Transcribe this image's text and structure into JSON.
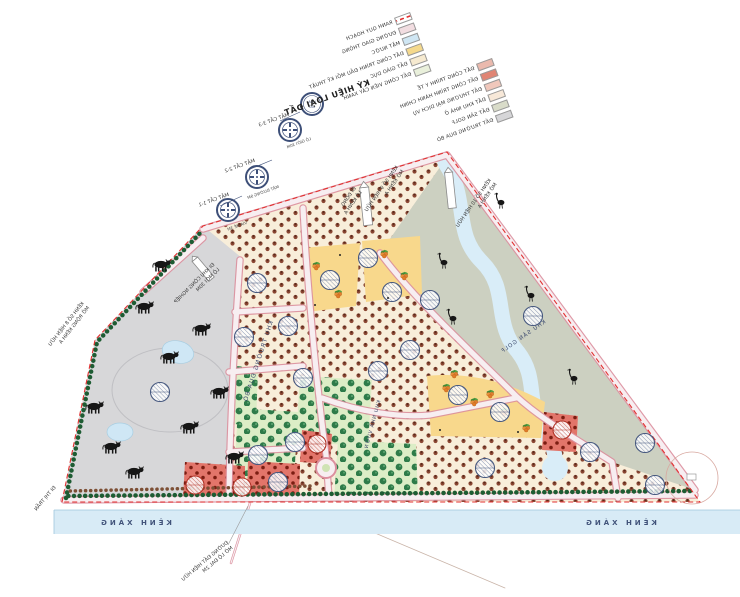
{
  "legend": {
    "title": "KÝ HIỆU LOẠI ĐẤT",
    "column_a": [
      {
        "label": "RANH QUY HOẠCH",
        "color": "#ffffff",
        "variant": "ranh"
      },
      {
        "label": "ĐƯỜNG GIAO THÔNG",
        "color": "#f2dde1"
      },
      {
        "label": "MẶT NƯỚC",
        "color": "#cfe6f3"
      },
      {
        "label": "ĐẤT CÔNG TRÌNH ĐẦU MỐI KỸ THUẬT",
        "color": "#f5d98c"
      },
      {
        "label": "ĐẤT GIÁO DỤC",
        "color": "#f6ead0"
      },
      {
        "label": "ĐẤT CÔNG VIÊN CÂY XANH",
        "color": "#e9f0db"
      }
    ],
    "column_b": [
      {
        "label": "ĐẤT CÔNG TRÌNH Y TẾ",
        "color": "#eab9ad"
      },
      {
        "label": "ĐẤT CÔNG TRÌNH HÀNH CHÍNH",
        "color": "#e08473"
      },
      {
        "label": "ĐẤT THƯƠNG MẠI DỊCH VỤ",
        "color": "#f0c7bb"
      },
      {
        "label": "ĐẤT KHU NHÀ Ở",
        "color": "#f7e8d8"
      },
      {
        "label": "ĐẤT SÂN GOLF",
        "color": "#d9dcc9"
      },
      {
        "label": "ĐẤT TRƯỜNG ĐUA BÒ",
        "color": "#d6d6d8"
      }
    ]
  },
  "map": {
    "zones": {
      "pasture": "KHU TRƯỜNG ĐUA BÒ",
      "golf": "KHU SÂN GOLF",
      "orchard": "KHU NHÀ VƯỜN"
    },
    "canal_label": "KÊNH XÁNG",
    "wind_rose": [
      "HOA",
      "GIÓ"
    ],
    "sections": [
      "MẶT CẮT 3-3",
      "MẶT CẮT 2-2",
      "MẶT CẮT 1-1"
    ],
    "dimensions": [
      "LỘ GIỚI 30M",
      "MẶT ĐƯỜNG 9M",
      "VỈA HÈ 3M"
    ],
    "edge_labels": [
      {
        "l1": "KÊNH SỐ 8 HIỆN HỮU",
        "l2": "MỞ RỘNG KÊNH A"
      },
      {
        "l1": "ĐI KHU CÔNG NGHIỆP",
        "l2": "LỘ MỚI 30M"
      },
      {
        "l1": "ĐI ĐỒNG",
        "l2": "LỘ KÊNH A"
      },
      {
        "l1": "KÊNH SỐ 9 HIỆN HỮU",
        "l2": "MỞ KÊNH A"
      },
      {
        "l1": "KÊNH SỐ 10 HIỆN HỮU",
        "l2": "MỞ KÊNH A"
      },
      {
        "l1": "ĐƯỜNG ĐẤT HIỆN HỮU",
        "l2": "MỞ LỘ ĐAL 2M"
      },
      {
        "l1": "ĐI THỊ TRẤN",
        "l2": ""
      }
    ]
  },
  "colors": {
    "pasture": "#d7d7d9",
    "golf": "#ccd0c1",
    "orchard_base": "#f8eeda",
    "yellow": "#f8d88c",
    "red_parcel": "#e2756a",
    "green_parcel": "#dcedc6",
    "water": "#cfe7f5",
    "canal": "#d8ebf6",
    "road_fill": "#f7eef1",
    "road_edge": "#dc8f9e",
    "boundary": "#e23030",
    "tree_row": "#1e5c33",
    "circle_navy": "#46587f",
    "circle_red": "#b03226",
    "label_navy": "#3c4a6e"
  }
}
